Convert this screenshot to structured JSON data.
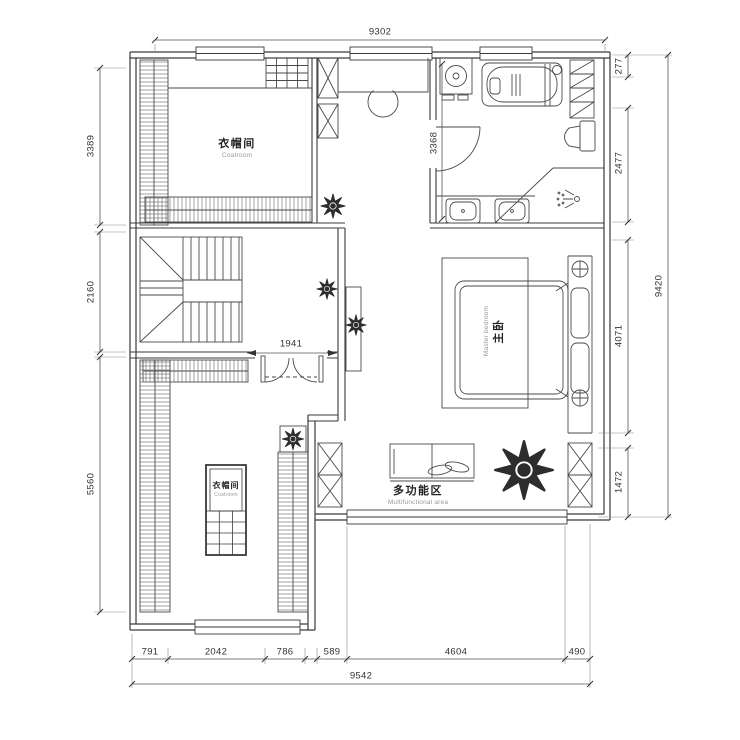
{
  "dimensions": {
    "top_total": "9302",
    "left": [
      "3389",
      "2160",
      "5560"
    ],
    "right": [
      "277",
      "2477",
      "4071",
      "1472"
    ],
    "right_total": "9420",
    "bottom": [
      "791",
      "2042",
      "786",
      "589",
      "4604",
      "490"
    ],
    "bottom_total": "9542",
    "bathroom_width": "3368",
    "door_opening": "1941"
  },
  "rooms": {
    "cloakroom_top": {
      "zh": "衣帽间",
      "en": "Coatroom"
    },
    "master_bedroom": {
      "zh": "主卧",
      "en": "Master bedroom"
    },
    "multifunctional": {
      "zh": "多功能区",
      "en": "Multifunctional area"
    },
    "cloakroom_island": {
      "zh": "衣帽间",
      "en": "Coatroom"
    }
  },
  "colors": {
    "line": "#3a3a3a",
    "text": "#333333",
    "muted": "#999999"
  }
}
